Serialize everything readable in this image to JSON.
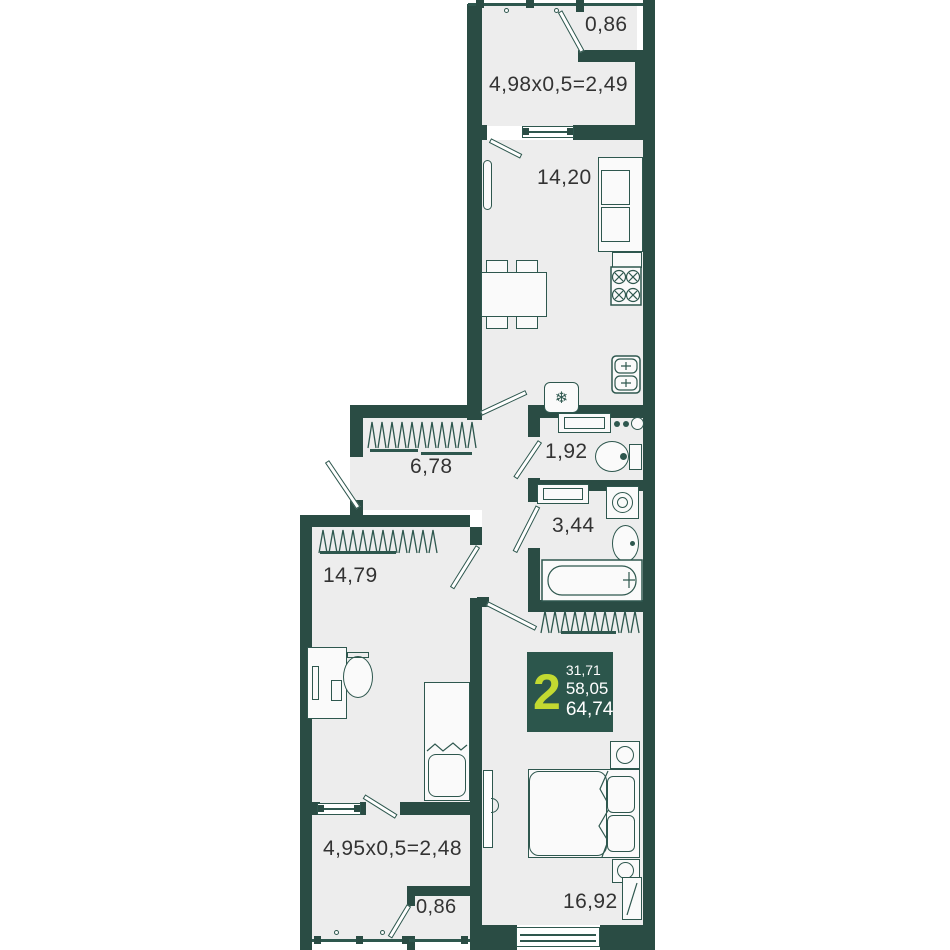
{
  "meta": {
    "title": "2-room apartment floor plan"
  },
  "colors": {
    "wall": "#2a4c44",
    "floor": "#ededed",
    "line": "#2e574e",
    "badge_bg": "#2c564c",
    "lime": "#c3d931",
    "text": "#333333"
  },
  "labels": {
    "balcony_top_storage": "0,86",
    "balcony_top": "4,98x0,5=2,49",
    "kitchen_living": "14,20",
    "hallway": "6,78",
    "wc": "1,92",
    "bathroom": "3,44",
    "bedroom1": "14,79",
    "balcony_bottom": "4,95x0,5=2,48",
    "balcony_bottom_storage": "0,86",
    "bedroom2": "16,92"
  },
  "badge": {
    "rooms": "2",
    "area_living": "31,71",
    "area_usable": "58,05",
    "area_total": "64,74"
  },
  "icons": {
    "fridge": "❄"
  }
}
